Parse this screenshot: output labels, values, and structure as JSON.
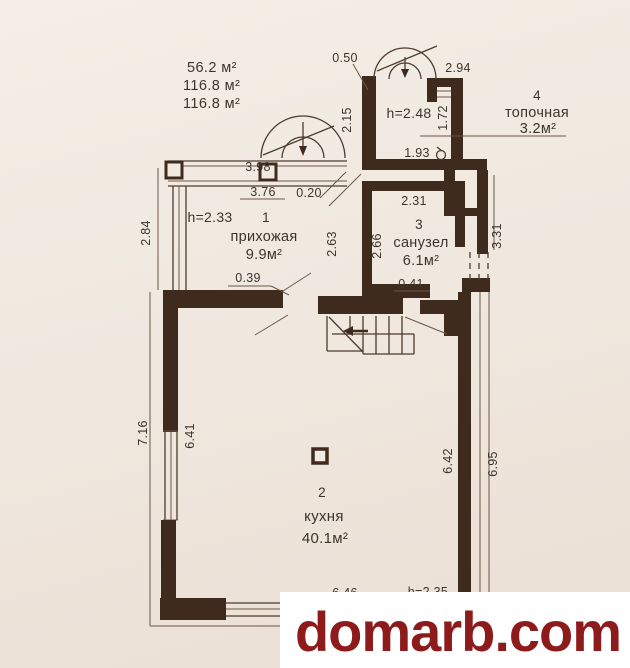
{
  "summary": {
    "l1": "56.2 м²",
    "l2": "116.8 м²",
    "l3": "116.8 м²"
  },
  "rooms": {
    "hallway": {
      "number": "1",
      "name": "прихожая",
      "area": "9.9м²",
      "height": "h=2.33"
    },
    "kitchen": {
      "number": "2",
      "name": "кухня",
      "area": "40.1м²",
      "height": "h=2.35"
    },
    "bathroom": {
      "number": "3",
      "name": "санузел",
      "area": "6.1м²"
    },
    "boiler": {
      "number": "4",
      "name": "топочная",
      "area": "3.2м²",
      "height": "h=2.48"
    }
  },
  "dims": {
    "w050": "0.50",
    "w294": "2.94",
    "w215": "2.15",
    "w172": "1.72",
    "w193": "1.93",
    "w398": "3.98",
    "w376": "3.76",
    "w020": "0.20",
    "w284": "2.84",
    "w263": "2.63",
    "w231": "2.31",
    "w266": "2.66",
    "w331": "3.31",
    "w039": "0.39",
    "w041": "0.41",
    "w716": "7.16",
    "w641": "6.41",
    "w642": "6.42",
    "w695": "6.95",
    "w646": "6.46"
  },
  "watermark": {
    "text": "domarb.com"
  },
  "colors": {
    "background": "#f1eae1",
    "wall": "#3e2b1e",
    "thin_line": "#6a5645",
    "label_text": "#3b352c",
    "watermark_red": "#8e1b1b",
    "watermark_bg": "#ffffff"
  }
}
